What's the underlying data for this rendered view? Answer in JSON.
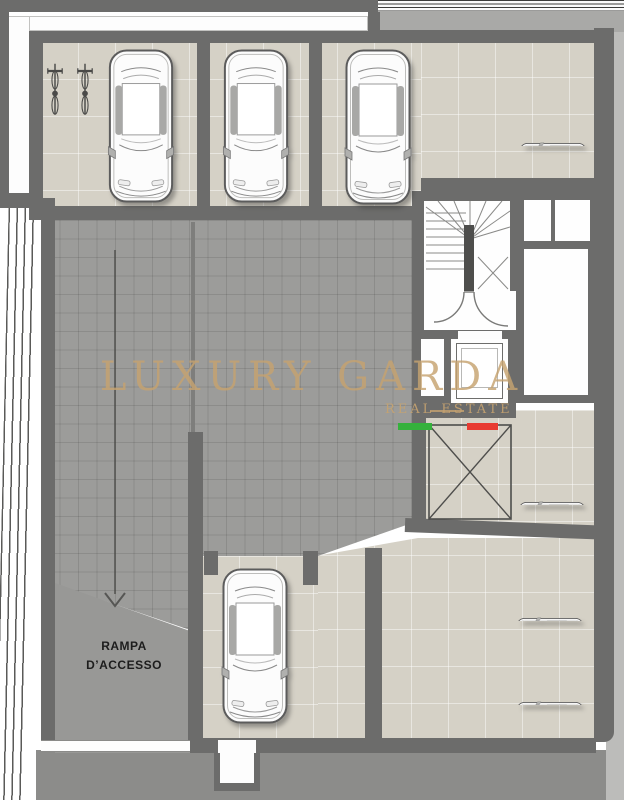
{
  "document": {
    "type": "basement-garage-floor-plan"
  },
  "watermark": {
    "title": "LUXURY GARDA",
    "subtitle": "REAL ESTATE"
  },
  "labels": {
    "ramp_line1": "RAMPA",
    "ramp_line2": "D’ACCESSO"
  },
  "plan": {
    "cars_drawn": 7,
    "bicycles_drawn": 2,
    "crossed_out_spaces": 1
  },
  "colors": {
    "wall": "#6c6c6b",
    "floor_beige": "#d5d1c6",
    "aisle": "#9c9c9a",
    "ramp": "#989896",
    "ground": "#8c8c8a",
    "watermark_gold": "#c6a370",
    "flag_green": "#35b13c",
    "flag_red": "#e83a31"
  }
}
